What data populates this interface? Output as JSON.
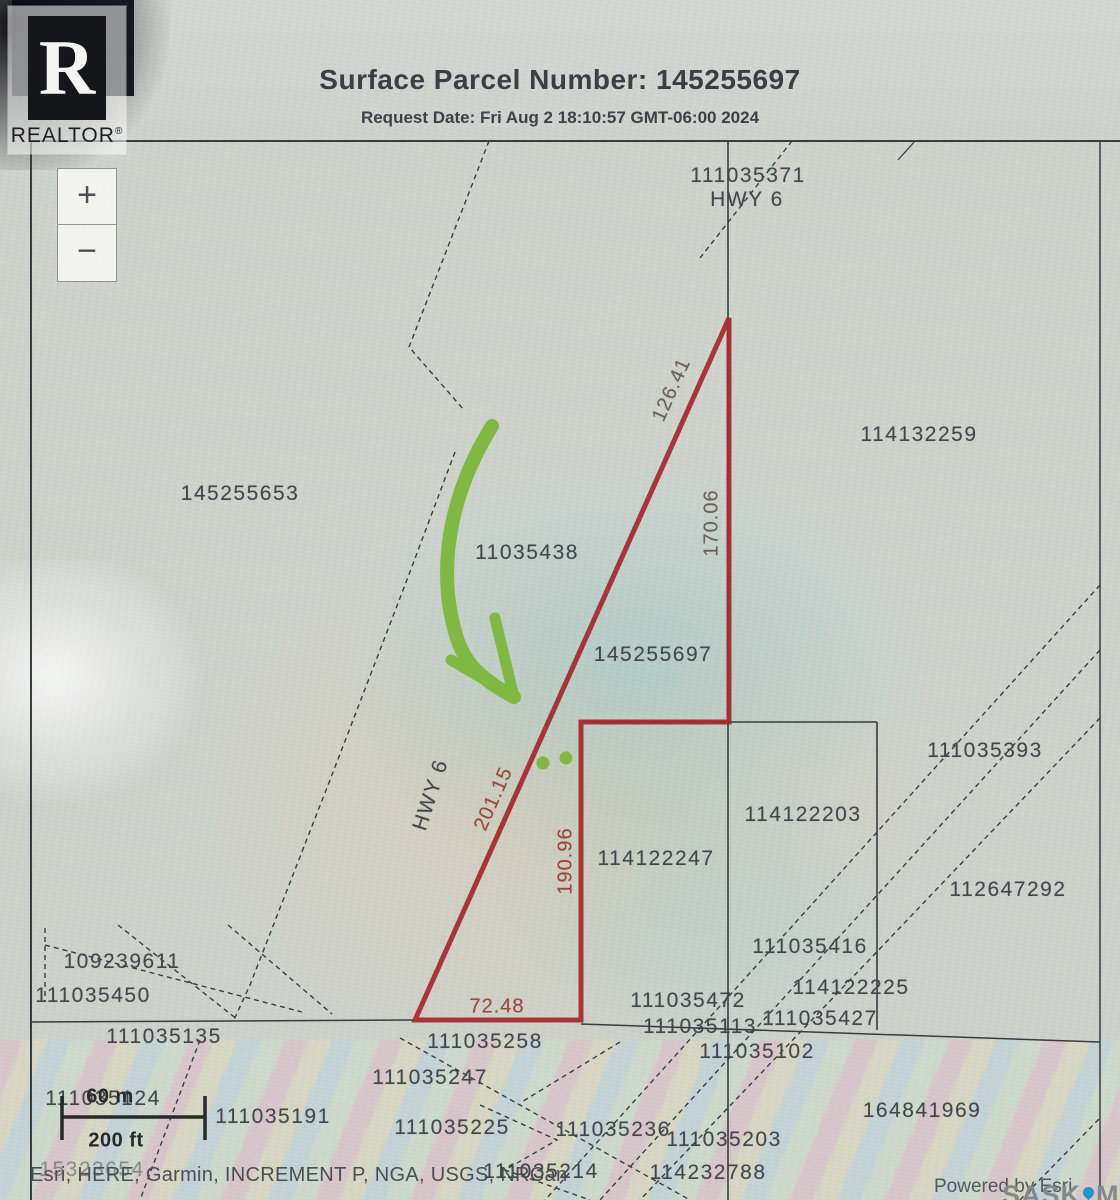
{
  "header": {
    "title": "Surface Parcel Number: 145255697",
    "request_date": "Request Date: Fri Aug 2 18:10:57 GMT-06:00 2024"
  },
  "logo": {
    "letter": "R",
    "word": "REALTOR",
    "registered": "®"
  },
  "zoom_controls": {
    "zoom_in": "+",
    "zoom_out": "−"
  },
  "colors": {
    "parcel_outline": "#a3282c",
    "arrow_green": "#7fb843",
    "line_black": "#383d40",
    "pin_blue": "#2196c9"
  },
  "parcels": [
    {
      "text": "111035371"
    },
    {
      "text": "HWY 6"
    },
    {
      "text": "114132259"
    },
    {
      "text": "145255653"
    },
    {
      "text": "11035438"
    },
    {
      "text": "145255697"
    },
    {
      "text": "111035393"
    },
    {
      "text": "114122203"
    },
    {
      "text": "114122247"
    },
    {
      "text": "112647292"
    },
    {
      "text": "111035416"
    },
    {
      "text": "114122225"
    },
    {
      "text": "109239611"
    },
    {
      "text": "111035450"
    },
    {
      "text": "111035135"
    },
    {
      "text": "111035472"
    },
    {
      "text": "111035113"
    },
    {
      "text": "111035427"
    },
    {
      "text": "111035102"
    },
    {
      "text": "111035258"
    },
    {
      "text": "111035247"
    },
    {
      "text": "111035124"
    },
    {
      "text": "111035191"
    },
    {
      "text": "111035225"
    },
    {
      "text": "111035236"
    },
    {
      "text": "111035203"
    },
    {
      "text": "111035214"
    },
    {
      "text": "114232788"
    },
    {
      "text": "164841969"
    },
    {
      "text": "15323654"
    },
    {
      "text": "HWY 6"
    }
  ],
  "measurements": {
    "side_ne": "126.41",
    "side_e": "170.06",
    "side_w": "201.15",
    "side_inner": "190.96",
    "side_s": "72.48"
  },
  "scale_bar": {
    "metric": "60 m",
    "imperial": "200 ft"
  },
  "attribution": {
    "sources": "Esri, HERE, Garmin, INCREMENT P, NGA, USGS, NRCan",
    "powered_by": "Powered by Esri",
    "brand_left": "SASK",
    "brand_right": "MLS",
    "brand_mark": "®"
  }
}
